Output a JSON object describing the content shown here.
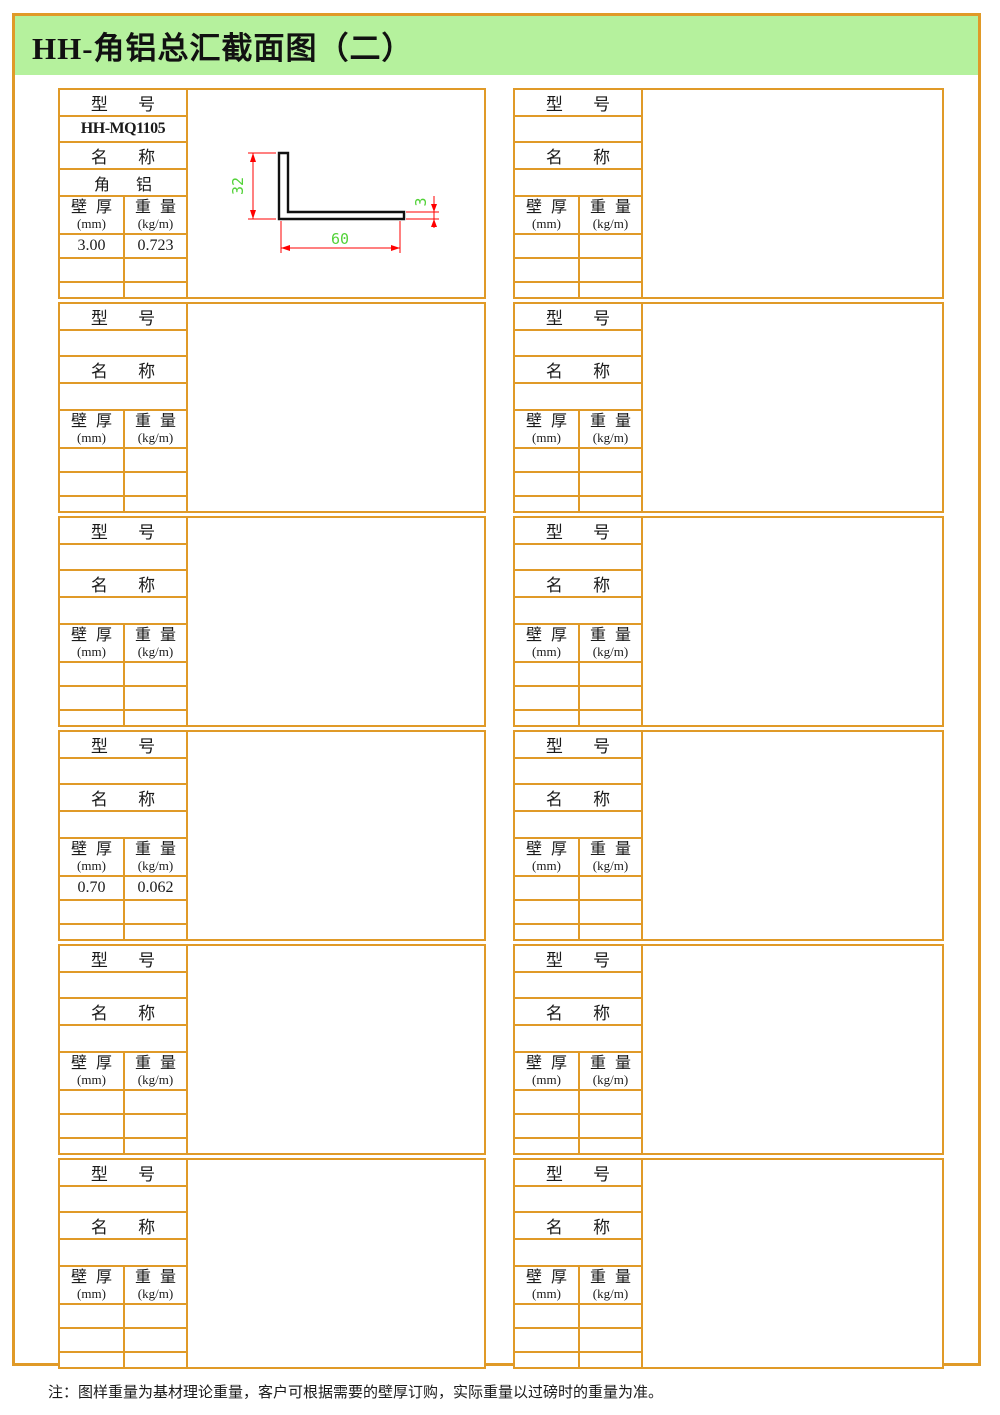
{
  "page": {
    "title": "HH-角铝总汇截面图（二）",
    "note": "注：图样重量为基材理论重量，客户可根据需要的壁厚订购，实际重量以过磅时的重量为准。",
    "colors": {
      "border_orange": "#E09A28",
      "header_green": "#B5F19D",
      "dimension_line_red": "#FF0000",
      "dimension_text_green": "#52D238"
    }
  },
  "labels": {
    "model": "型 号",
    "name": "名 称",
    "thickness": "壁 厚",
    "thickness_unit": "(mm)",
    "weight": "重 量",
    "weight_unit": "(kg/m)"
  },
  "blocks": [
    {
      "model": "HH-MQ1105",
      "name": "角 铝",
      "rows": [
        [
          "3.00",
          "0.723"
        ],
        [
          "",
          ""
        ],
        [
          "",
          ""
        ]
      ],
      "drawing": {
        "height_label": "32",
        "width_label": "60",
        "thickness_label": "3"
      }
    },
    {
      "model": "",
      "name": "",
      "rows": [
        [
          "",
          ""
        ],
        [
          "",
          ""
        ],
        [
          "",
          ""
        ]
      ]
    },
    {
      "model": "",
      "name": "",
      "rows": [
        [
          "",
          ""
        ],
        [
          "",
          ""
        ],
        [
          "",
          ""
        ]
      ]
    },
    {
      "model": "",
      "name": "",
      "rows": [
        [
          "",
          ""
        ],
        [
          "",
          ""
        ],
        [
          "",
          ""
        ]
      ]
    },
    {
      "model": "",
      "name": "",
      "rows": [
        [
          "",
          ""
        ],
        [
          "",
          ""
        ],
        [
          "",
          ""
        ]
      ]
    },
    {
      "model": "",
      "name": "",
      "rows": [
        [
          "",
          ""
        ],
        [
          "",
          ""
        ],
        [
          "",
          ""
        ]
      ]
    },
    {
      "model": "",
      "name": "",
      "rows": [
        [
          "0.70",
          "0.062"
        ],
        [
          "",
          ""
        ],
        [
          "",
          ""
        ]
      ]
    },
    {
      "model": "",
      "name": "",
      "rows": [
        [
          "",
          ""
        ],
        [
          "",
          ""
        ],
        [
          "",
          ""
        ]
      ]
    },
    {
      "model": "",
      "name": "",
      "rows": [
        [
          "",
          ""
        ],
        [
          "",
          ""
        ],
        [
          "",
          ""
        ]
      ]
    },
    {
      "model": "",
      "name": "",
      "rows": [
        [
          "",
          ""
        ],
        [
          "",
          ""
        ],
        [
          "",
          ""
        ]
      ]
    },
    {
      "model": "",
      "name": "",
      "rows": [
        [
          "",
          ""
        ],
        [
          "",
          ""
        ],
        [
          "",
          ""
        ]
      ]
    },
    {
      "model": "",
      "name": "",
      "rows": [
        [
          "",
          ""
        ],
        [
          "",
          ""
        ],
        [
          "",
          ""
        ]
      ]
    }
  ]
}
